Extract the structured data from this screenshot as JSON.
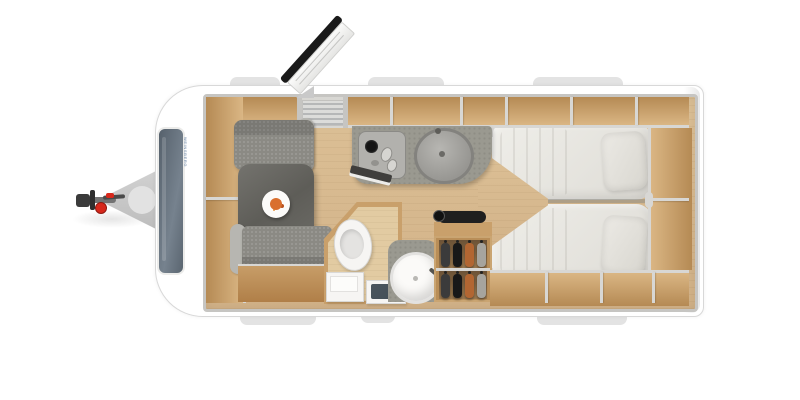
{
  "scene": {
    "description": "Top-down caravan travel-trailer floor plan, front hitch at left, twin beds at rear",
    "brand": {
      "text": "WEINSBERG"
    }
  },
  "colors": {
    "background": "#ffffff",
    "body_white": "#ffffff",
    "body_border": "#d8d8d8",
    "ext_tab": "#e3e3e3",
    "wall_gray": "#c6c5c2",
    "trim_gray": "#d8d7d4",
    "floor_wood": "#d9bc92",
    "locker_wood": "#dab684",
    "locker_back": "#b58a54",
    "seat_gray": "#8b8a84",
    "seat_trim": "#b7b6b1",
    "table_gray": "#67665f",
    "counter_gray": "#9a9990",
    "mattress": "#eae8e3",
    "white_fixture": "#f6f5f3",
    "mat_slate": "#434e57",
    "window_glass": "#626d79",
    "door_dark": "#1a1a1a",
    "accent_red": "#d7281c",
    "hitch_gray": "#c7c7c7",
    "coupler_dark": "#4a4a4a",
    "food_orange": "#d96f2e",
    "clothes": [
      "#3b3b3b",
      "#181818",
      "#b26632",
      "#a6a49e"
    ]
  },
  "parts": [
    "tow-hitch",
    "coupling-head",
    "red-jockey-knob",
    "panoramic-front-window",
    "front-overhead-lockers",
    "dinette-bench-front",
    "dinette-bench-rear",
    "dinette-table",
    "dinner-plate",
    "entrance-door-open",
    "entry-mat",
    "kitchen-hob",
    "kitchen-sink",
    "overhead-lockers-top",
    "overhead-lockers-bottom",
    "toilet",
    "entry-step",
    "shower-mat",
    "round-washbasin",
    "wardrobe-with-clothes",
    "soundbar",
    "twin-bed-left",
    "twin-bed-right",
    "pillows",
    "rear-shelf",
    "exterior-window-flaps"
  ]
}
